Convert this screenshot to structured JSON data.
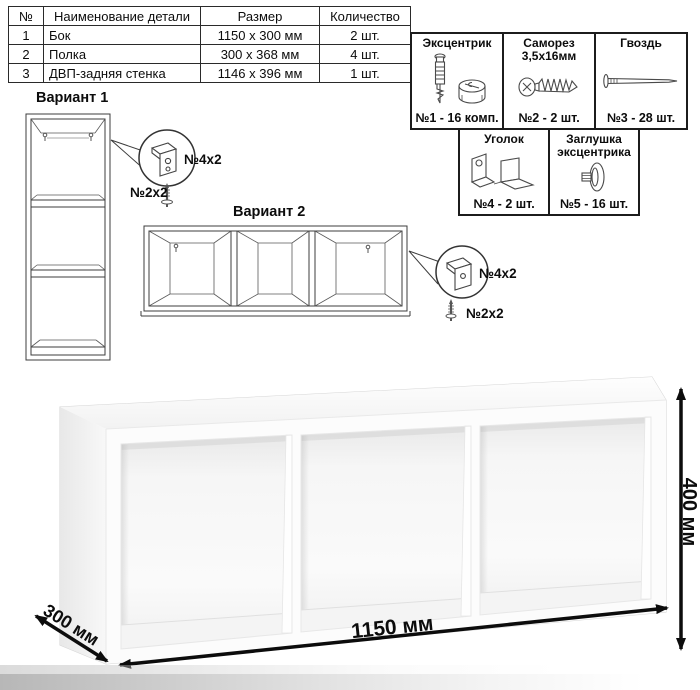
{
  "parts_table": {
    "headers": [
      "№",
      "Наименование детали",
      "Размер",
      "Количество"
    ],
    "rows": [
      {
        "num": "1",
        "name": "Бок",
        "size": "1150 x 300 мм",
        "qty": "2 шт."
      },
      {
        "num": "2",
        "name": "Полка",
        "size": "300 x 368 мм",
        "qty": "4 шт."
      },
      {
        "num": "3",
        "name": "ДВП-задняя стенка",
        "size": "1146 x 396 мм",
        "qty": "1 шт."
      }
    ]
  },
  "hardware": {
    "items": [
      {
        "title": "Эксцентрик",
        "label": "№1 - 16 комп.",
        "icon": "eccentric-icon"
      },
      {
        "title": "Саморез 3,5х16мм",
        "label": "№2 - 2 шт.",
        "icon": "screw-icon"
      },
      {
        "title": "Гвоздь",
        "label": "№3 - 28 шт.",
        "icon": "nail-icon"
      },
      {
        "title": "Уголок",
        "label": "№4 - 2 шт.",
        "icon": "bracket-icon"
      },
      {
        "title": "Заглушка эксцентрика",
        "label": "№5 - 16 шт.",
        "icon": "cap-icon"
      }
    ]
  },
  "variants": {
    "v1": {
      "title": "Вариант 1",
      "bracket_label": "№4х2",
      "screw_label": "№2х2"
    },
    "v2": {
      "title": "Вариант 2",
      "bracket_label": "№4х2",
      "screw_label": "№2х2"
    }
  },
  "dimensions": {
    "width": "1150 мм",
    "height": "400 мм",
    "depth": "300 мм"
  },
  "colors": {
    "line": "#2b2b2b",
    "floor_shade": "#b7b7b7"
  }
}
